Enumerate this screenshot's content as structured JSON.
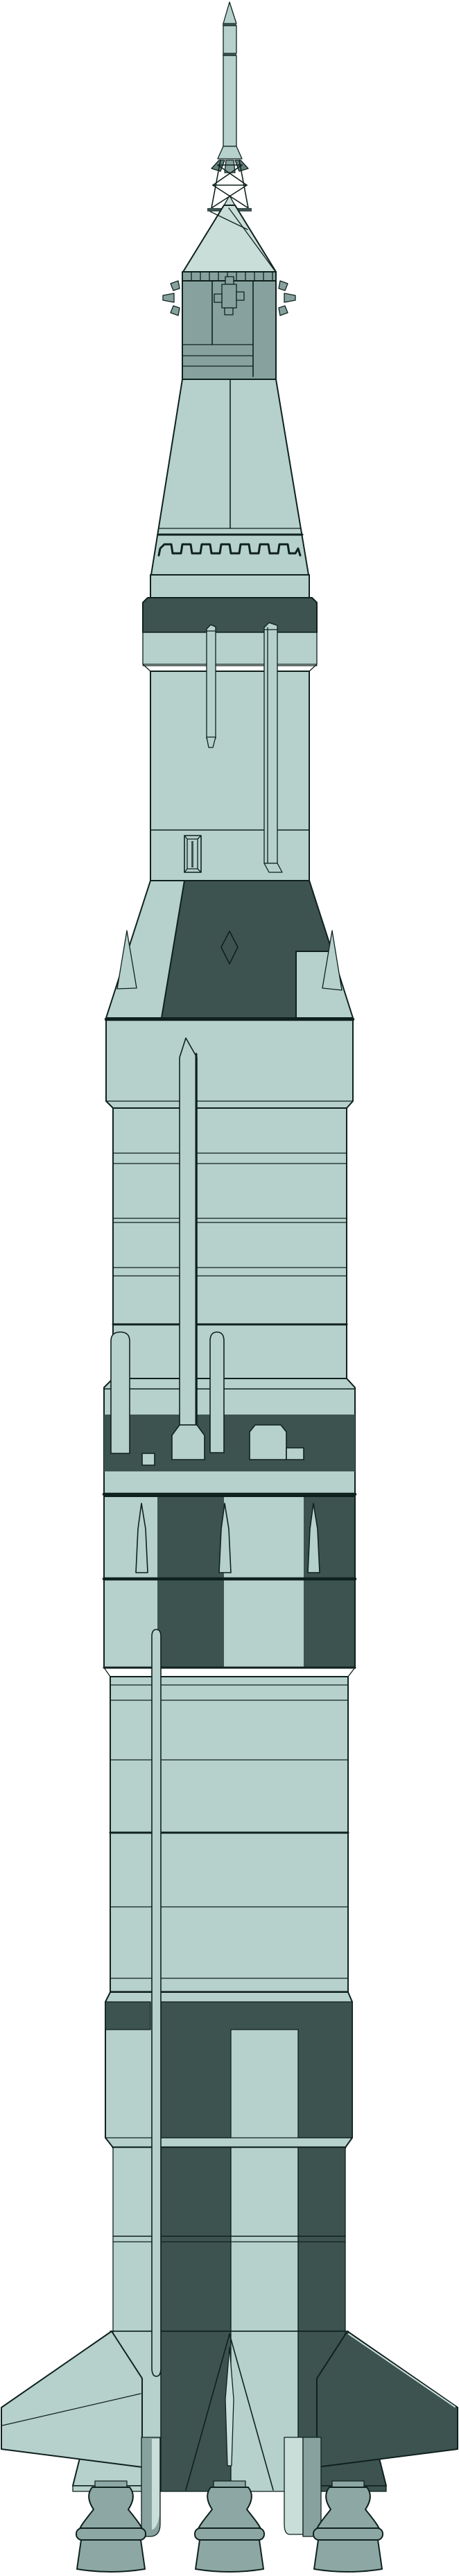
{
  "illustration": {
    "subject": "Saturn V launch vehicle technical illustration",
    "orientation": "vertical, nose at top, engines at bottom",
    "background": "plain white",
    "parts": [
      "launch-escape-motor",
      "escape-tower-lattice",
      "command-module",
      "service-module",
      "rcs-thruster-quads",
      "spacecraft-lm-adapter",
      "separation-crenellation-band",
      "instrument-unit-band",
      "s-ivb-third-stage",
      "cable-tunnels",
      "s-ivb-aft-interstage",
      "s-ii-second-stage",
      "ullage-motor-pods",
      "systems-tunnel",
      "interstage-checkerboard",
      "retro-rocket-fairings",
      "s-ic-first-stage",
      "lox-tunnel",
      "base-roll-pattern-stripes",
      "fins",
      "engine-fairings",
      "f1-engine-bells"
    ]
  },
  "palette": {
    "background": "#ffffff",
    "hull_light": "#b6d0cc",
    "hull_lighter": "#c9ddd9",
    "hull_mid": "#87a29e",
    "hull_dark": "#3d5350",
    "nozzle_gray": "#64807b",
    "engine_gray": "#8da8a4",
    "outline": "#0f211d"
  }
}
